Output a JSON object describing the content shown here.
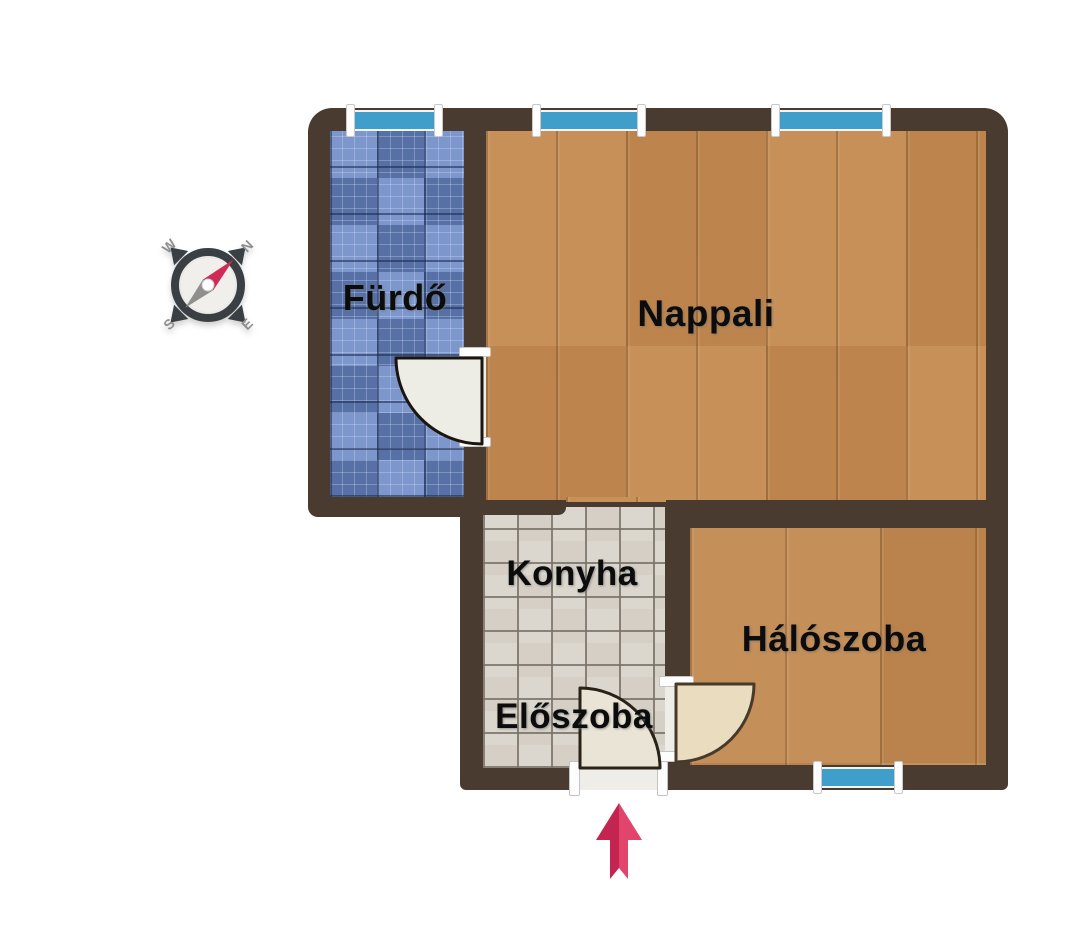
{
  "title": "Apartment floor plan",
  "rooms": [
    {
      "id": "furdo",
      "label": "Fürdő"
    },
    {
      "id": "nappali",
      "label": "Nappali"
    },
    {
      "id": "konyha",
      "label": "Konyha"
    },
    {
      "id": "eloszoba",
      "label": "Előszoba"
    },
    {
      "id": "haloszoba",
      "label": "Hálószoba"
    }
  ],
  "compass": {
    "north": "N",
    "east": "E",
    "south": "S",
    "west": "W"
  },
  "icons": {
    "compass": "compass-rose-icon",
    "entrance": "entrance-arrow-icon",
    "windows": "window-symbol",
    "doors": "door-swing-symbol"
  },
  "colors": {
    "background": "#ffffff",
    "wall": "#4a3b31",
    "window_glass": "#3f9fca",
    "window_frame": "#f4f4f4",
    "floor_living_wood": "#c38a51",
    "floor_bedroom_wood": "#c08850",
    "floor_bath_tile": "#7490c8",
    "floor_hall_tile": "#dbd7cf",
    "door_leaf": "#eae4d6",
    "label_text": "#0c0c0c",
    "compass_ring": "#3a3f43",
    "compass_needle_north": "#cf2b55",
    "compass_needle_south": "#8f8f8d",
    "entrance_arrow": "#cf2b55"
  }
}
